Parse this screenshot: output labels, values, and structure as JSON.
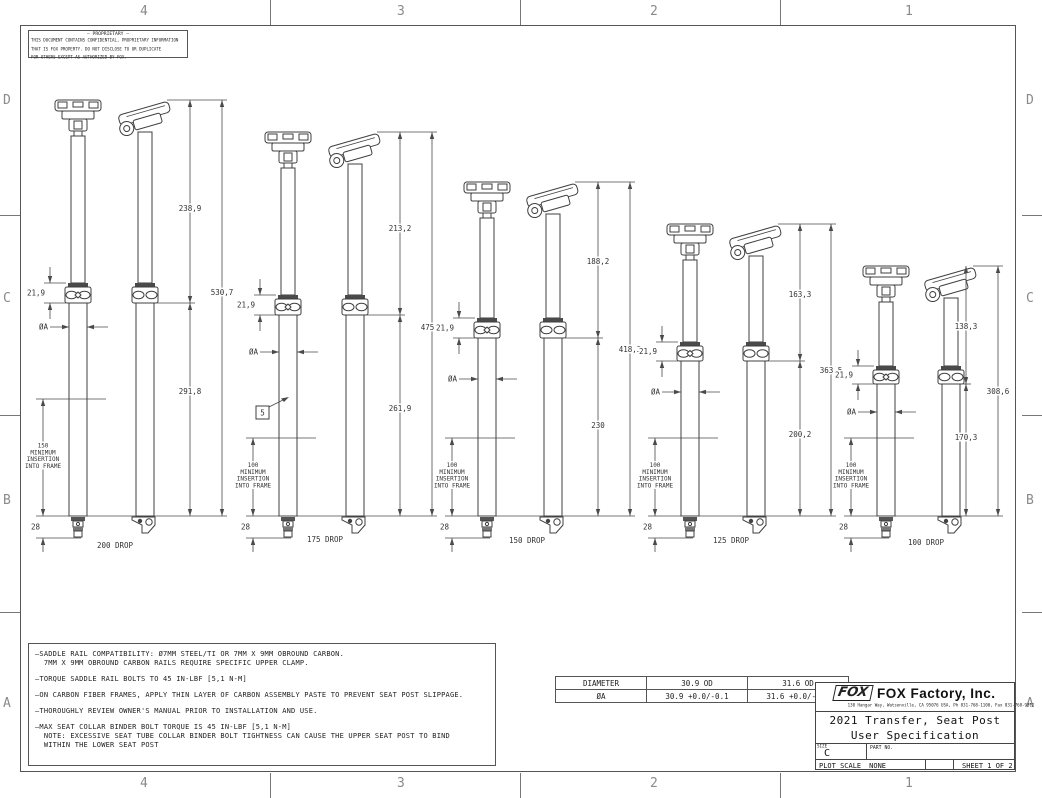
{
  "frame": {
    "top_zones": [
      "4",
      "3",
      "2",
      "1"
    ],
    "bottom_zones": [
      "4",
      "3",
      "2",
      "1"
    ],
    "left_zones": [
      "D",
      "C",
      "B",
      "A"
    ],
    "right_zones": [
      "D",
      "C",
      "B",
      "A"
    ]
  },
  "proprietary": {
    "title": "— PROPRIETARY —",
    "lines": [
      "THIS DOCUMENT CONTAINS CONFIDENTIAL, PROPRIETARY INFORMATION",
      "THAT IS FOX PROPERTY.  DO NOT DISCLOSE TO OR DUPLICATE",
      "FOR OTHERS EXCEPT AS AUTHORIZED BY FOX."
    ]
  },
  "posts": [
    {
      "id": "200",
      "upper": "238,9",
      "lower": "291,8",
      "total": "530,7",
      "collar": "21,9",
      "diameter": "ØA",
      "insertion_lines": [
        "150",
        "MINIMUM",
        "INSERTION",
        "INTO FRAME"
      ],
      "stub": "28",
      "drop": "200 DROP"
    },
    {
      "id": "175",
      "upper": "213,2",
      "lower": "261,9",
      "total": "475,1",
      "collar": "21,9",
      "diameter": "ØA",
      "insertion_lines": [
        "100",
        "MINIMUM",
        "INSERTION",
        "INTO FRAME"
      ],
      "stub": "28",
      "drop": "175 DROP",
      "flag": "5"
    },
    {
      "id": "150",
      "upper": "188,2",
      "lower": "230",
      "total": "418,3",
      "collar": "21,9",
      "diameter": "ØA",
      "insertion_lines": [
        "100",
        "MINIMUM",
        "INSERTION",
        "INTO FRAME"
      ],
      "stub": "28",
      "drop": "150 DROP"
    },
    {
      "id": "125",
      "upper": "163,3",
      "lower": "200,2",
      "total": "363,5",
      "collar": "21,9",
      "diameter": "ØA",
      "insertion_lines": [
        "100",
        "MINIMUM",
        "INSERTION",
        "INTO FRAME"
      ],
      "stub": "28",
      "drop": "125 DROP"
    },
    {
      "id": "100",
      "upper": "138,3",
      "lower": "170,3",
      "total": "308,6",
      "collar": "21,9",
      "diameter": "ØA",
      "insertion_lines": [
        "100",
        "MINIMUM",
        "INSERTION",
        "INTO FRAME"
      ],
      "stub": "28",
      "drop": "100 DROP"
    }
  ],
  "notes": [
    [
      "SADDLE RAIL COMPATIBILITY: Ø7MM STEEL/TI OR 7MM X 9MM OBROUND CARBON.",
      "7MM X 9MM OBROUND CARBON RAILS REQUIRE SPECIFIC UPPER CLAMP."
    ],
    [
      "TORQUE SADDLE RAIL BOLTS TO 45 IN-LBF [5,1 N-M]"
    ],
    [
      "ON CARBON FIBER FRAMES, APPLY THIN LAYER OF CARBON ASSEMBLY PASTE TO PREVENT SEAT POST SLIPPAGE."
    ],
    [
      "THOROUGHLY REVIEW OWNER'S MANUAL PRIOR TO INSTALLATION AND USE."
    ],
    [
      "MAX SEAT COLLAR BINDER BOLT TORQUE IS 45 IN-LBF [5,1 N-M]",
      "NOTE: EXCESSIVE SEAT TUBE COLLAR BINDER BOLT TIGHTNESS CAN CAUSE THE UPPER SEAT POST TO BIND",
      "WITHIN THE LOWER SEAT POST"
    ]
  ],
  "table": {
    "headers": [
      "DIAMETER",
      "30.9 OD",
      "31.6 OD"
    ],
    "rows": [
      [
        "ØA",
        "30.9 +0.0/-0.1",
        "31.6 +0.0/-0.1"
      ]
    ]
  },
  "title_block": {
    "logo": "FOX",
    "company": "FOX Factory, Inc.",
    "address": "130 Hangar Way, Watsonville, CA 95076 USA, Ph 831-768-1100, Fax 831-768-9312",
    "title_line1": "2021 Transfer, Seat Post",
    "title_line2": "User Specification",
    "size_label": "SIZE",
    "size_value": "C",
    "part_label": "PART NO.",
    "plot_label": "PLOT SCALE",
    "plot_value": "NONE",
    "sheet": "SHEET 1 OF 2"
  },
  "colors": {
    "line": "#4a4a4a",
    "text": "#333333",
    "zone_text": "#8a8a8a",
    "dark_band": "#4a4a4a"
  }
}
